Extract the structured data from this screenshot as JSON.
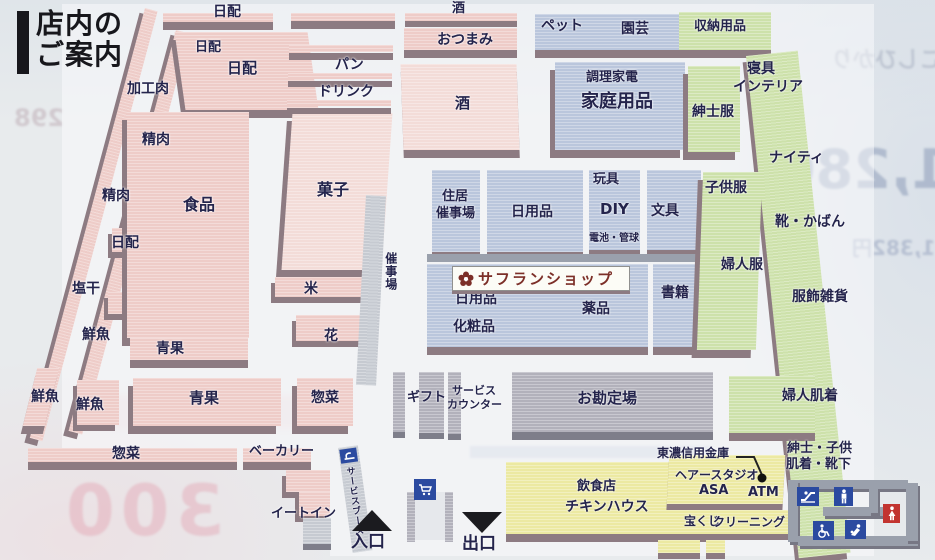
{
  "title": {
    "line1": "店内の",
    "line2": "ご案内"
  },
  "labels": {
    "nippai_top": "日配",
    "nippai_col": "日配",
    "nippai_big": "日配",
    "nippai_left": "日配",
    "kakoniku": "加工肉",
    "seiniku_upper": "精肉",
    "seiniku_lower": "精肉",
    "shioboshi": "塩干",
    "sengyo_upper": "鮮魚",
    "sengyo_left": "鮮魚",
    "sengyo_lower": "鮮魚",
    "shokuhin": "食品",
    "seika_strip": "青果",
    "seika_block": "青果",
    "kashi": "菓子",
    "kome": "米",
    "hana": "花",
    "saijijo_corridor": "催事場",
    "sozai_block": "惣菜",
    "sozai_strip": "惣菜",
    "bakery": "ベーカリー",
    "eatin": "イートイン",
    "service_booth": "サービスブース",
    "sake_top": "酒",
    "otsumami": "おつまみ",
    "pan": "パン",
    "drink": "ドリンク",
    "sake_main": "酒",
    "pet": "ペット",
    "engei": "園芸",
    "shuno": "収納用品",
    "chori_kaden": "調理家電",
    "katei_yohin": "家庭用品",
    "shinshi_fuku": "紳士服",
    "shingu": "寝具",
    "interia": "インテリア",
    "naity": "ナイティ",
    "jukyo_line1": "住居",
    "jukyo_line2": "催事場",
    "nichiyo_upper": "日用品",
    "omocha": "玩具",
    "diy": "DIY",
    "denchi": "電池・管球",
    "bungu": "文具",
    "saffron_shop": "サフランショップ",
    "nichiyo_lower": "日用品",
    "yakuhin": "薬品",
    "keshohin": "化粧品",
    "shoseki": "書籍",
    "kodomo_fuku": "子供服",
    "fujin_fuku": "婦人服",
    "kutsu_kaban": "靴・かばん",
    "fukushoku_zakka": "服飾雑貨",
    "gift": "ギフト",
    "service_counter_1": "サービス",
    "service_counter_2": "カウンター",
    "okanjoba": "お勘定場",
    "fujin_hadagi": "婦人肌着",
    "shinshi_kodomo_1": "紳士・子供",
    "shinshi_kodomo_2": "肌着・靴下",
    "tono_bank": "東濃信用金庫",
    "atm": "ATM",
    "hair_studio": "ヘアースタジオ",
    "hair_studio_asa": "ASA",
    "takarakuji": "宝くじ",
    "cleaning": "クリーニング",
    "inshokuten": "飲食店",
    "chicken_house": "チキンハウス",
    "iriguchi": "入口",
    "deguchi": "出口"
  },
  "icons": [
    "service-booth-icon",
    "cart-icon",
    "escalator-icon",
    "mens-restroom-icon",
    "womens-restroom-icon",
    "wheelchair-icon",
    "baby-room-icon"
  ],
  "colors": {
    "fresh_food_pink": "#eeccc8",
    "household_blue": "#bac6dc",
    "clothing_green": "#cde1aa",
    "service_yellow": "#ece9a2",
    "counter_gray": "#b2b1bb",
    "shelf_edge": "#8d7b82",
    "label_navy": "#24244c",
    "icon_blue": "#2b4aa0",
    "icon_red": "#c23430"
  },
  "bleed": {
    "right_line1": "こしひかり",
    "right_price": "1,280",
    "right_price2": "1,382円",
    "left_price": "298",
    "bottom_left_price": "300"
  }
}
